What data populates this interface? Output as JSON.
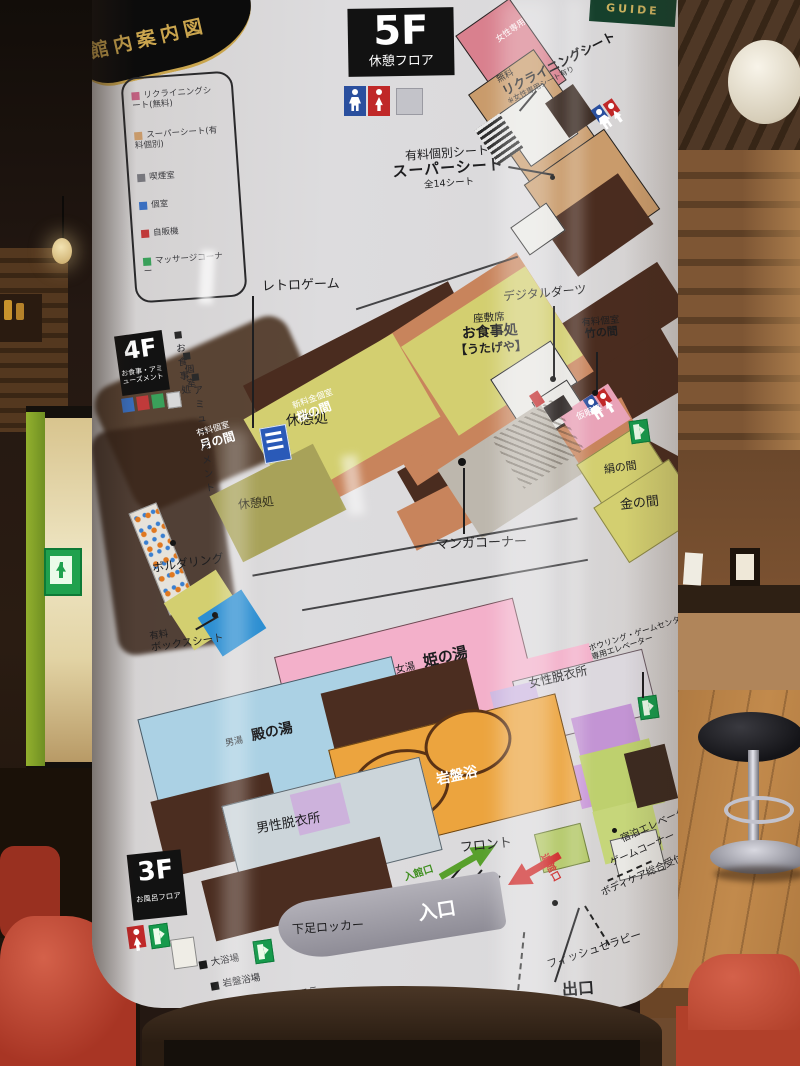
{
  "banners": {
    "kanban": "館内案内図",
    "guide": "GUIDE"
  },
  "f5": {
    "tag": "5F",
    "caption": "休憩フロア",
    "legend": [
      "リクライニングシート(無料)",
      "スーパーシート(有料個別)",
      "喫煙室",
      "個室",
      "自販機",
      "マッサージコーナー"
    ],
    "women_only": "女性専用",
    "free": "無料",
    "reclining": "リクライニングシート",
    "reclining_note": "※女性専用シート有り",
    "super_seat_type": "有料個別シート",
    "super_seat": "スーパーシート",
    "super_seat_count": "全14シート"
  },
  "f4": {
    "tag": "4F",
    "caption": "お食事・アミューズメント",
    "legend": [
      "お食事処",
      "個室",
      "アミューズメント"
    ],
    "retro_game": "レトロゲーム",
    "digital_darts": "デジタルダーツ",
    "zashiki": "座敷席",
    "dining": "お食事処",
    "utageya": "【うたげや】",
    "paid_room": "有料個室",
    "take_room": "竹の間",
    "new_room": "新料金個室",
    "sakura_room": "桜の間",
    "paid_room2": "有料個室",
    "tsuki_room": "月の間",
    "rest_area": "休憩処",
    "rest_area_left": "休憩処",
    "nap_room": "仮眠処",
    "kinu_room": "絹の間",
    "kin_room": "金の間",
    "manga_corner": "マンガコーナー",
    "bouldering": "ボルダリング",
    "box_seat_1": "有料",
    "box_seat_2": "ボックスシート"
  },
  "f3": {
    "tag": "3F",
    "caption": "お風呂フロア",
    "legend": [
      "大浴場",
      "岩盤浴場",
      "ボディケア・エステ",
      "ボウリング・ゲームセンター 直通エレベーター"
    ],
    "women_bath_prefix": "女湯",
    "women_bath": "姫の湯",
    "men_bath_prefix": "男湯",
    "men_bath": "殿の湯",
    "women_dressing": "女性脱衣所",
    "men_dressing": "男性脱衣所",
    "ganbanyoku": "岩盤浴",
    "front": "フロント",
    "entry_gate": "入館口",
    "exit_gate": "退館口",
    "entrance": "入口",
    "exit": "出口",
    "shoe_locker": "下足ロッカー",
    "pay_machine": "精算機",
    "fish_therapy": "フィッシュセラピー",
    "bodycare": "ボディケア総合受付",
    "game_corner": "ゲームコーナー",
    "stay_elevator": "宿泊エレベーター",
    "bowling_ev_1": "ボウリング・ゲームセンター",
    "bowling_ev_2": "専用エレベーター"
  }
}
